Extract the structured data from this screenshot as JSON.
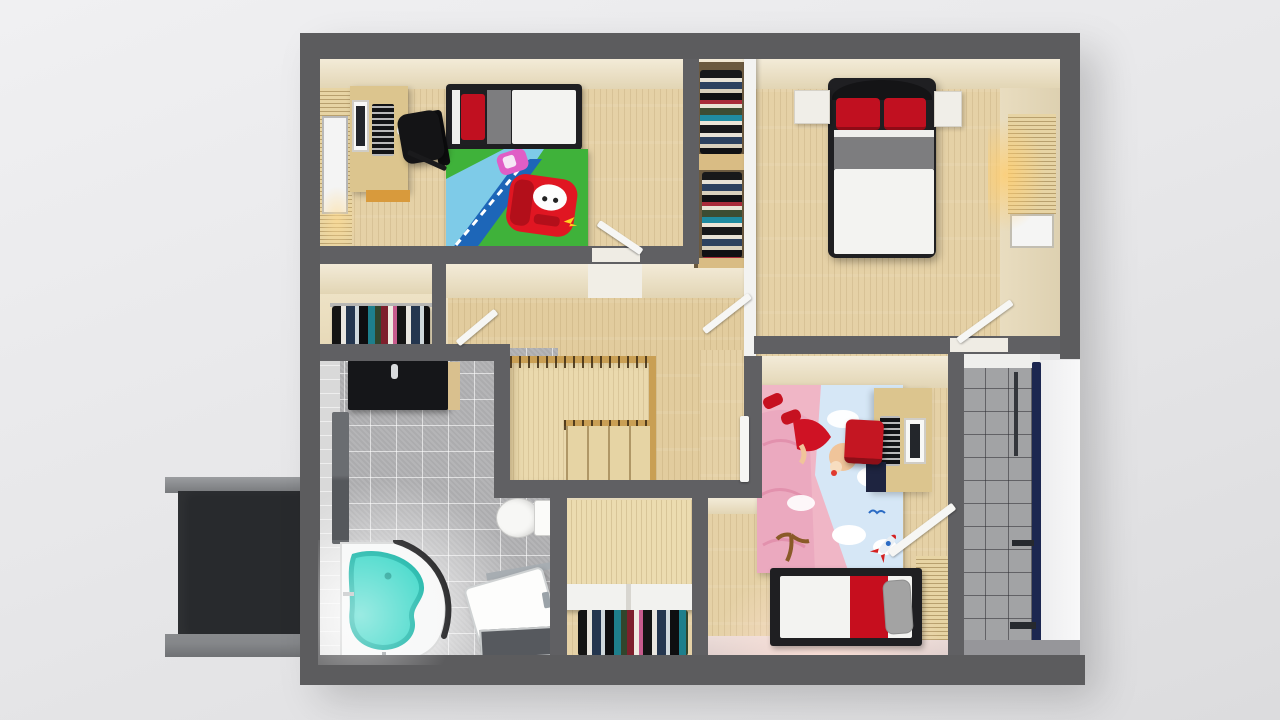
{
  "scene": {
    "type": "3d-floorplan-top-down-render",
    "description": "Upper floor of a house seen from above: two children's bedrooms, master bedroom, bathroom, stair hall, walk-in closet, balcony and a dark annex roof"
  },
  "palette": {
    "background": "#e9e9eb",
    "exterior_wall": "#5c5c5e",
    "interior_wall": "#606063",
    "white_partition": "#f3f3f1",
    "wood_floor": "#e5d1a6",
    "hall_wood": "#e2cc9e",
    "stair_wood": "#ead9ad",
    "cream_wall_face": "#ecdfc2",
    "bathroom_tile": "#b5b5b7",
    "balcony_tile": "#a2a3a5",
    "balcony_railing": "#1c2750",
    "annex_dark": "#282a2d",
    "annex_trim": "#85878a",
    "vanity_black": "#151619",
    "bathtub_water": "#35d6c6",
    "bathtub_water_edge": "#10b3a5",
    "bed_frame": "#1f1f22",
    "mattress": "#f3f3f1",
    "blanket_gray": "#7d7d7f",
    "pillow_red": "#c11020",
    "bed_runner_red": "#c60e1e",
    "chair_black": "#141416",
    "chair_red": "#c41622",
    "desk_wood": "#dcc58e",
    "rug_grass": "#3fb23a",
    "rug_road_light": "#7ecbe8",
    "rug_road_dark": "#1d66b8",
    "rug_car_red": "#e01622",
    "mural_pink": "#f0b6c6",
    "mural_sky": "#d6e7f6",
    "toilet_white": "#f7f7f5",
    "door_white": "#f6f6f4"
  },
  "rooms": {
    "kids_bedroom_cars": {
      "items": [
        "single bed with red pillow and gray blanket band",
        "computer desk with monitor and keyboard",
        "black office chair",
        "Lightning McQueen cars rug",
        "window with wood blinds"
      ]
    },
    "master_bedroom": {
      "items": [
        "double bed with two red pillows",
        "white nightstand left",
        "white nightstand right",
        "wardrobe column with folded clothes",
        "window with blinds and warm light",
        "open doors"
      ]
    },
    "stair_hall": {
      "items": [
        "staircase with wood balustrade",
        "open doors to bedrooms and bathroom"
      ]
    },
    "hall_closet_nook": {
      "items": [
        "clothes rail with hanging garments"
      ]
    },
    "bathroom": {
      "items": [
        "black vanity counter with faucet",
        "tall gray cabinet",
        "corner bathtub with teal water",
        "toilet",
        "shower base with dark mat"
      ]
    },
    "walk_in_closet": {
      "items": [
        "white shelf with divider",
        "clothes rail with hanging garments"
      ]
    },
    "kids_bedroom_pink": {
      "items": [
        "single bed with red runner and gray pillow",
        "desk with monitor and keyboard",
        "red desk chair",
        "pink cartoon floor mural with clouds, tree and rocket",
        "open door to balcony",
        "window blinds"
      ]
    },
    "balcony": {
      "items": [
        "gray tile floor",
        "navy railing",
        "white lit walkway"
      ]
    },
    "annex_roof": {
      "items": [
        "dark flat roof with gray trim bars"
      ]
    }
  }
}
